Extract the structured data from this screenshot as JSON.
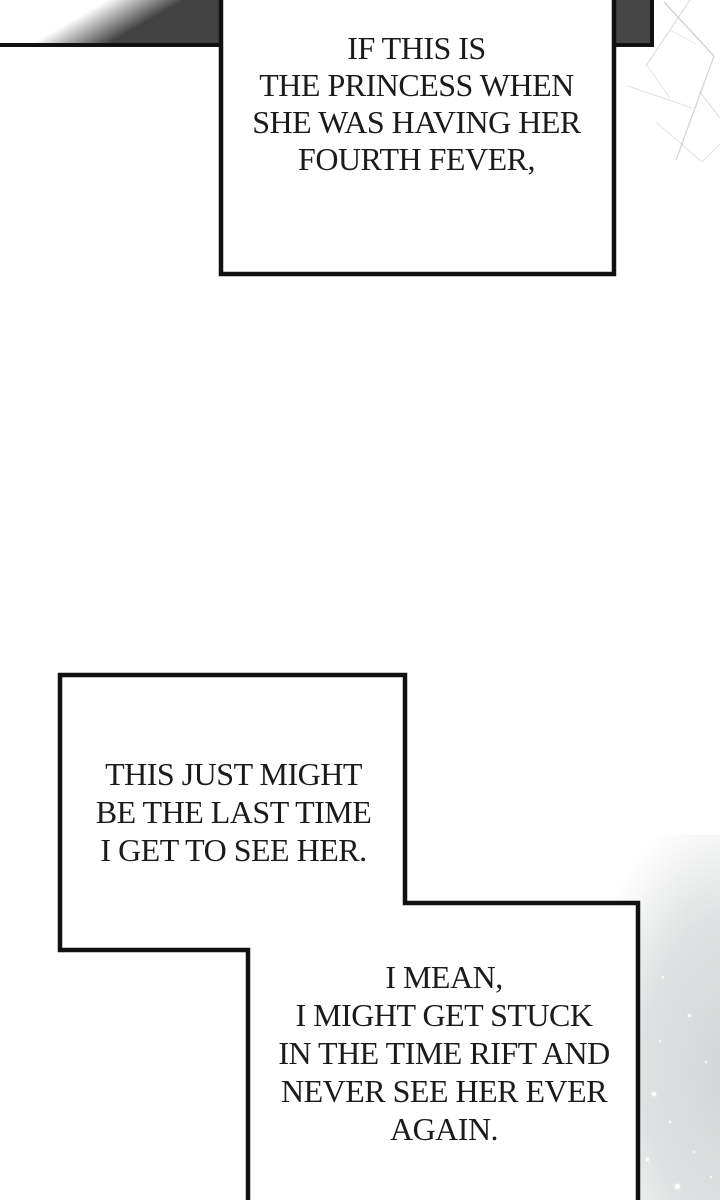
{
  "balloons": {
    "top": {
      "lines": [
        "IF THIS IS",
        "THE PRINCESS WHEN",
        "SHE WAS HAVING HER",
        "FOURTH FEVER,"
      ]
    },
    "middle": {
      "lines": [
        "THIS JUST MIGHT",
        "BE THE LAST TIME",
        "I GET TO SEE HER."
      ]
    },
    "bottom": {
      "lines": [
        "I MEAN,",
        "I MIGHT GET STUCK",
        "IN THE TIME RIFT AND",
        "NEVER SEE HER EVER",
        "AGAIN."
      ]
    }
  },
  "colors": {
    "outline": "#111111",
    "band_dark": "#454545",
    "haze": "#d6d8d9",
    "crack_line": "#c2c2c2",
    "text": "#1b1b1b",
    "background": "#ffffff"
  }
}
